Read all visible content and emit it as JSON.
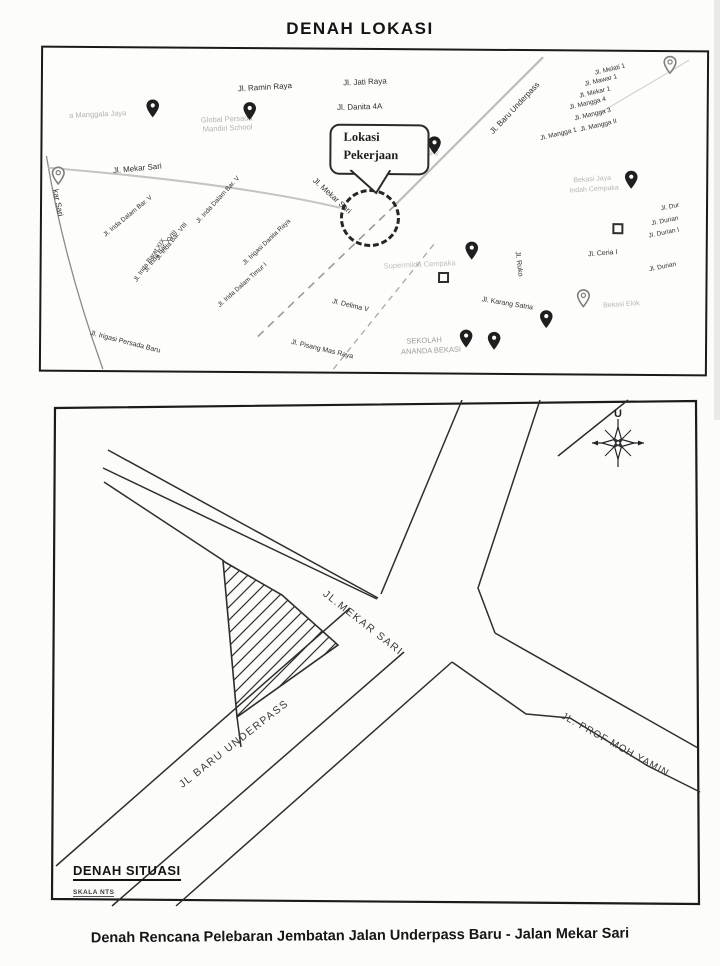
{
  "page": {
    "title": "DENAH LOKASI",
    "caption": "Denah Rencana Pelebaran Jembatan Jalan Underpass Baru - Jalan Mekar Sari"
  },
  "top_map": {
    "callout": {
      "line1": "Lokasi",
      "line2": "Pekerjaan"
    },
    "labels": [
      {
        "t": "Jl. Ramin Raya",
        "x": 222,
        "y": 38,
        "r": -4,
        "s": 8
      },
      {
        "t": "Jl. Jati Raya",
        "x": 322,
        "y": 32,
        "r": -3,
        "s": 8
      },
      {
        "t": "Jl. Danita 4A",
        "x": 317,
        "y": 57,
        "r": -2,
        "s": 8
      },
      {
        "t": "Jl. Mekar Sari",
        "x": 95,
        "y": 120,
        "r": -6,
        "s": 8
      },
      {
        "t": "Jl. Baru Underpass",
        "x": 472,
        "y": 57,
        "r": -47,
        "s": 8
      },
      {
        "t": "Jl. Melati 1",
        "x": 567,
        "y": 18,
        "r": -14,
        "s": 6.5
      },
      {
        "t": "Jl. Mawar 1",
        "x": 558,
        "y": 29,
        "r": -14,
        "s": 6.5
      },
      {
        "t": "Jl. Mekar 1",
        "x": 552,
        "y": 41,
        "r": -14,
        "s": 6.5
      },
      {
        "t": "Jl. Mangga 4",
        "x": 545,
        "y": 52,
        "r": -14,
        "s": 6.5
      },
      {
        "t": "Jl. Mangga 3",
        "x": 550,
        "y": 63,
        "r": -14,
        "s": 6.5
      },
      {
        "t": "Jl. Mangga II",
        "x": 556,
        "y": 74,
        "r": -14,
        "s": 6.5
      },
      {
        "t": "Jl. Mangga 1",
        "x": 516,
        "y": 83,
        "r": -14,
        "s": 6.5
      },
      {
        "t": "Jl. Mekar Sari",
        "x": 290,
        "y": 146,
        "r": 42,
        "s": 8
      },
      {
        "t": "kar Sari",
        "x": 16,
        "y": 155,
        "r": 78,
        "s": 8
      },
      {
        "t": "Jl. Irida Dalam Bar. V",
        "x": 86,
        "y": 168,
        "r": -40,
        "s": 6.5
      },
      {
        "t": "Jl. Irida Bar. VIII",
        "x": 130,
        "y": 193,
        "r": -52,
        "s": 6.5
      },
      {
        "t": "Jl. Irida Bar. XVIII",
        "x": 119,
        "y": 203,
        "r": -54,
        "s": 6.5
      },
      {
        "t": "Jl. Irida Barat XIX",
        "x": 108,
        "y": 212,
        "r": -56,
        "s": 6.5
      },
      {
        "t": "Jl. Irida Dalam Bar. V",
        "x": 176,
        "y": 151,
        "r": -48,
        "s": 6.5
      },
      {
        "t": "Jl. Irigasi Danita Raya",
        "x": 225,
        "y": 193,
        "r": -44,
        "s": 6.5
      },
      {
        "t": "Jl. Irida Dalam Timur I",
        "x": 201,
        "y": 236,
        "r": -42,
        "s": 6.5
      },
      {
        "t": "Jl. Irigasi Persada Baru",
        "x": 84,
        "y": 294,
        "r": 14,
        "s": 7
      },
      {
        "t": "Jl. Delima V",
        "x": 309,
        "y": 256,
        "r": 13,
        "s": 7
      },
      {
        "t": "Jl. Pisang Mas Raya",
        "x": 281,
        "y": 300,
        "r": 13,
        "s": 7
      },
      {
        "t": "Jl. Karang Satria",
        "x": 466,
        "y": 253,
        "r": 9,
        "s": 7
      },
      {
        "t": "Jl. Ruko",
        "x": 477,
        "y": 213,
        "r": 82,
        "s": 7
      },
      {
        "t": "Jl. Ceria I",
        "x": 561,
        "y": 202,
        "r": -5,
        "s": 7
      },
      {
        "t": "Jl. Dur",
        "x": 628,
        "y": 155,
        "r": -12,
        "s": 6.5
      },
      {
        "t": "Jl. Durian",
        "x": 623,
        "y": 169,
        "r": -12,
        "s": 6.5
      },
      {
        "t": "Jl. Durian I",
        "x": 622,
        "y": 181,
        "r": -12,
        "s": 6.5
      },
      {
        "t": "Jl. Durian",
        "x": 621,
        "y": 215,
        "r": -12,
        "s": 6.5
      },
      {
        "t": "a Manggala Jaya",
        "x": 55,
        "y": 66,
        "r": -3,
        "s": 7.5,
        "c": "#b3b3b0"
      },
      {
        "t": "Global Persada",
        "x": 184,
        "y": 70,
        "r": -3,
        "s": 7.5,
        "c": "#b3b3b0"
      },
      {
        "t": "Mandiri School",
        "x": 185,
        "y": 79,
        "r": -3,
        "s": 7.5,
        "c": "#b3b3b0"
      },
      {
        "t": "ata Bekasi 2",
        "x": 376,
        "y": 103,
        "r": -2,
        "s": 7.5,
        "c": "#b3b3b0"
      },
      {
        "t": "Supermilda Cempaka",
        "x": 378,
        "y": 214,
        "r": -3,
        "s": 7.5,
        "c": "#c0c0bd"
      },
      {
        "t": "SEKOLAH",
        "x": 383,
        "y": 290,
        "r": -3,
        "s": 7.5,
        "c": "#9c9c98"
      },
      {
        "t": "ANANDA BEKASI",
        "x": 390,
        "y": 300,
        "r": -3,
        "s": 7.5,
        "c": "#9c9c98"
      },
      {
        "t": "Bekasi Jaya",
        "x": 550,
        "y": 128,
        "r": -4,
        "s": 7,
        "c": "#b8b8b4"
      },
      {
        "t": "Indah Cempaka",
        "x": 552,
        "y": 138,
        "r": -4,
        "s": 7,
        "c": "#b8b8b4"
      },
      {
        "t": "Bekasi Elok",
        "x": 580,
        "y": 253,
        "r": -4,
        "s": 7,
        "c": "#b8b8b4"
      }
    ],
    "pins": [
      {
        "x": 110,
        "y": 60,
        "v": "solid"
      },
      {
        "x": 207,
        "y": 62,
        "v": "solid"
      },
      {
        "x": 392,
        "y": 95,
        "v": "solid"
      },
      {
        "x": 430,
        "y": 200,
        "v": "solid"
      },
      {
        "x": 589,
        "y": 128,
        "v": "solid"
      },
      {
        "x": 16,
        "y": 128,
        "v": "outline"
      },
      {
        "x": 505,
        "y": 268,
        "v": "solid"
      },
      {
        "x": 425,
        "y": 288,
        "v": "solid"
      },
      {
        "x": 453,
        "y": 290,
        "v": "solid"
      },
      {
        "x": 542,
        "y": 247,
        "v": "outline"
      },
      {
        "x": 627,
        "y": 13,
        "v": "outline"
      }
    ],
    "squares": [
      {
        "x": 402,
        "y": 227
      },
      {
        "x": 576,
        "y": 177
      }
    ]
  },
  "situation": {
    "north_label": "U",
    "labels": [
      {
        "t": "JL.MEKAR SARI",
        "x": 315,
        "y": 225,
        "r": 38,
        "s": 10.5,
        "ls": 1.5
      },
      {
        "t": "JL BARU UNDERPASS",
        "x": 186,
        "y": 346,
        "r": -38,
        "s": 10.5,
        "ls": 1.5
      },
      {
        "t": "JL. PROF MOH YAMIN",
        "x": 567,
        "y": 347,
        "r": 29,
        "s": 10,
        "ls": 1
      }
    ],
    "legend": {
      "title": "DENAH SITUASI",
      "scale": "SKALA NTS"
    }
  }
}
